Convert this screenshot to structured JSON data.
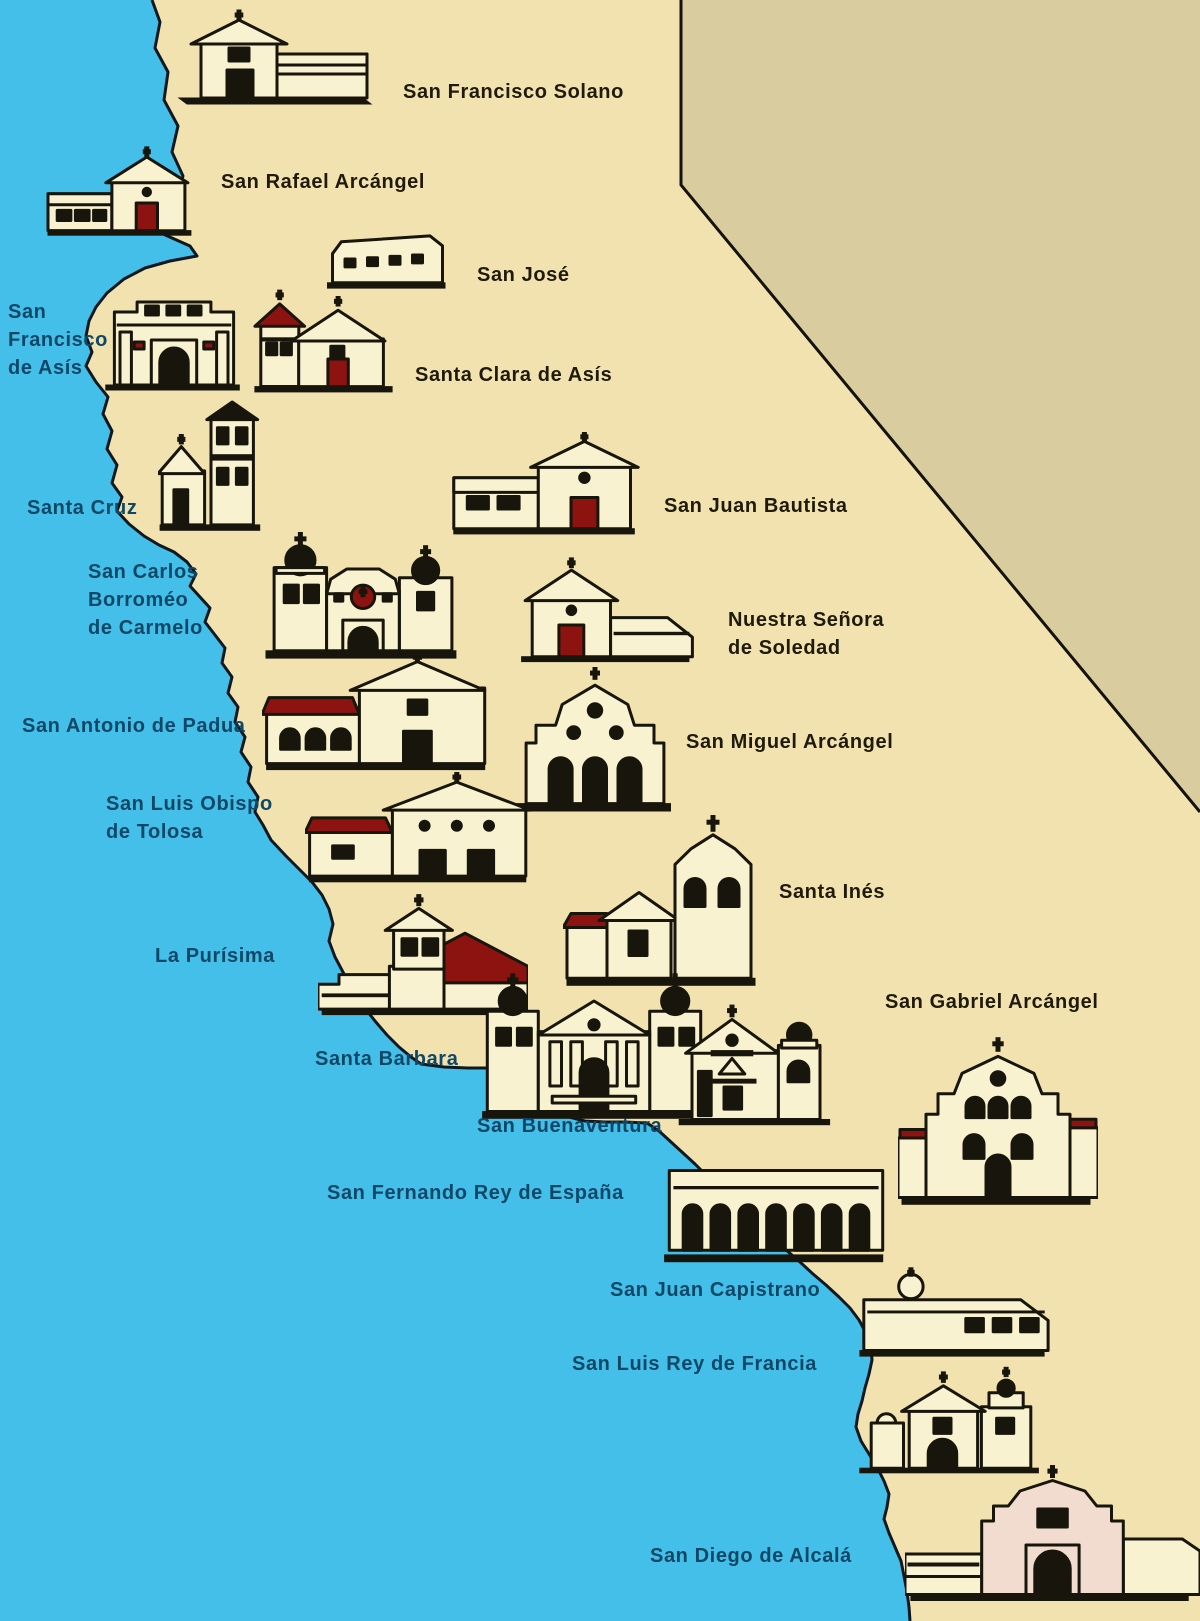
{
  "map": {
    "colors": {
      "ocean": "#44BFEA",
      "land": "#F1E2B0",
      "outside_land": "#D9CC9E",
      "coast_line": "#10181F",
      "border_line": "#14120A",
      "label_water": "#0F4766",
      "label_land": "#1F1A0B",
      "icon_cream": "#F9F2D0",
      "icon_ink": "#18160C",
      "icon_red": "#8C1310",
      "icon_pink": "#F2DCD0"
    },
    "missions": [
      {
        "slug": "san-francisco-solano",
        "name": "San Francisco Solano",
        "icon": {
          "x": 175,
          "y": 8,
          "w": 200,
          "h": 100,
          "variant": "solano"
        },
        "label": {
          "text": "San Francisco Solano",
          "x": 403,
          "y": 78,
          "on": "land"
        }
      },
      {
        "slug": "san-rafael-arcangel",
        "name": "San Rafael Arcángel",
        "icon": {
          "x": 45,
          "y": 146,
          "w": 152,
          "h": 92,
          "variant": "rafael"
        },
        "label": {
          "text": "San Rafael Arcángel",
          "x": 221,
          "y": 168,
          "on": "land"
        }
      },
      {
        "slug": "san-jose",
        "name": "San José",
        "icon": {
          "x": 325,
          "y": 226,
          "w": 125,
          "h": 66,
          "variant": "jose"
        },
        "label": {
          "text": "San José",
          "x": 477,
          "y": 261,
          "on": "land"
        }
      },
      {
        "slug": "san-francisco-de-asis",
        "name": "San Francisco de Asís",
        "icon": {
          "x": 103,
          "y": 292,
          "w": 142,
          "h": 100,
          "variant": "asis"
        },
        "label": {
          "text": "San\nFrancisco\nde Asís",
          "x": 8,
          "y": 298,
          "on": "water"
        }
      },
      {
        "slug": "santa-clara-de-asis",
        "name": "Santa Clara de Asís",
        "icon": {
          "x": 252,
          "y": 288,
          "w": 146,
          "h": 106,
          "variant": "clara"
        },
        "label": {
          "text": "Santa Clara de Asís",
          "x": 415,
          "y": 361,
          "on": "land"
        }
      },
      {
        "slug": "santa-cruz",
        "name": "Santa Cruz",
        "icon": {
          "x": 158,
          "y": 398,
          "w": 106,
          "h": 135,
          "variant": "cruz"
        },
        "label": {
          "text": "Santa Cruz",
          "x": 27,
          "y": 494,
          "on": "water"
        }
      },
      {
        "slug": "san-juan-bautista",
        "name": "San Juan Bautista",
        "icon": {
          "x": 450,
          "y": 432,
          "w": 192,
          "h": 104,
          "variant": "bautista"
        },
        "label": {
          "text": "San Juan Bautista",
          "x": 664,
          "y": 492,
          "on": "land"
        }
      },
      {
        "slug": "san-carlos-borromeo-de-carmelo",
        "name": "San Carlos Borroméo de Carmelo",
        "icon": {
          "x": 262,
          "y": 515,
          "w": 202,
          "h": 146,
          "variant": "carlos"
        },
        "label": {
          "text": "San Carlos\nBorroméo\nde Carmelo",
          "x": 88,
          "y": 558,
          "on": "water"
        }
      },
      {
        "slug": "nuestra-senora-de-soledad",
        "name": "Nuestra Señora de Soledad",
        "icon": {
          "x": 518,
          "y": 542,
          "w": 178,
          "h": 122,
          "variant": "soledad"
        },
        "label": {
          "text": "Nuestra Señora\nde Soledad",
          "x": 728,
          "y": 606,
          "on": "land"
        }
      },
      {
        "slug": "san-antonio-de-padua",
        "name": "San Antonio de Padua",
        "icon": {
          "x": 262,
          "y": 652,
          "w": 232,
          "h": 120,
          "variant": "antonio"
        },
        "label": {
          "text": "San Antonio de Padua",
          "x": 22,
          "y": 712,
          "on": "water"
        }
      },
      {
        "slug": "san-miguel-arcangel",
        "name": "San Miguel Arcángel",
        "icon": {
          "x": 513,
          "y": 666,
          "w": 164,
          "h": 148,
          "variant": "miguel"
        },
        "label": {
          "text": "San Miguel Arcángel",
          "x": 686,
          "y": 728,
          "on": "land"
        }
      },
      {
        "slug": "san-luis-obispo-de-tolosa",
        "name": "San Luis Obispo de Tolosa",
        "icon": {
          "x": 305,
          "y": 772,
          "w": 230,
          "h": 112,
          "variant": "luisobispo"
        },
        "label": {
          "text": "San Luis Obispo\nde Tolosa",
          "x": 106,
          "y": 790,
          "on": "water"
        }
      },
      {
        "slug": "santa-ines",
        "name": "Santa Inés",
        "icon": {
          "x": 563,
          "y": 812,
          "w": 200,
          "h": 175,
          "variant": "ines"
        },
        "label": {
          "text": "Santa Inés",
          "x": 779,
          "y": 878,
          "on": "land"
        }
      },
      {
        "slug": "la-purisima",
        "name": "La Purísima",
        "icon": {
          "x": 318,
          "y": 878,
          "w": 210,
          "h": 138,
          "variant": "purisima"
        },
        "label": {
          "text": "La Purísima",
          "x": 155,
          "y": 942,
          "on": "water"
        }
      },
      {
        "slug": "santa-barbara",
        "name": "Santa Barbara",
        "icon": {
          "x": 478,
          "y": 950,
          "w": 232,
          "h": 170,
          "variant": "barbara"
        },
        "label": {
          "text": "Santa Barbara",
          "x": 315,
          "y": 1045,
          "on": "water"
        }
      },
      {
        "slug": "san-buenaventura",
        "name": "San Buenaventura",
        "icon": {
          "x": 676,
          "y": 996,
          "w": 160,
          "h": 130,
          "variant": "buenaventura"
        },
        "label": {
          "text": "San Buenaventura",
          "x": 477,
          "y": 1112,
          "on": "water"
        }
      },
      {
        "slug": "san-gabriel-arcangel",
        "name": "San Gabriel Arcángel",
        "icon": {
          "x": 898,
          "y": 1036,
          "w": 200,
          "h": 170,
          "variant": "gabriel"
        },
        "label": {
          "text": "San Gabriel Arcángel",
          "x": 885,
          "y": 988,
          "on": "land"
        }
      },
      {
        "slug": "san-fernando-rey-de-espana",
        "name": "San Fernando Rey de España",
        "icon": {
          "x": 660,
          "y": 1150,
          "w": 232,
          "h": 114,
          "variant": "fernando"
        },
        "label": {
          "text": "San Fernando Rey de España",
          "x": 327,
          "y": 1179,
          "on": "water"
        }
      },
      {
        "slug": "san-juan-capistrano",
        "name": "San Juan Capistrano",
        "icon": {
          "x": 856,
          "y": 1264,
          "w": 196,
          "h": 94,
          "variant": "capistrano"
        },
        "label": {
          "text": "San Juan Capistrano",
          "x": 610,
          "y": 1276,
          "on": "water"
        }
      },
      {
        "slug": "san-luis-rey-de-francia",
        "name": "San Luis Rey de Francia",
        "icon": {
          "x": 856,
          "y": 1358,
          "w": 190,
          "h": 116,
          "variant": "luisrey"
        },
        "label": {
          "text": "San Luis Rey de Francia",
          "x": 572,
          "y": 1350,
          "on": "water"
        }
      },
      {
        "slug": "san-diego-de-alcala",
        "name": "San Diego de Alcalá",
        "icon": {
          "x": 905,
          "y": 1452,
          "w": 295,
          "h": 150,
          "variant": "diego"
        },
        "label": {
          "text": "San Diego de Alcalá",
          "x": 650,
          "y": 1542,
          "on": "water"
        }
      }
    ]
  }
}
